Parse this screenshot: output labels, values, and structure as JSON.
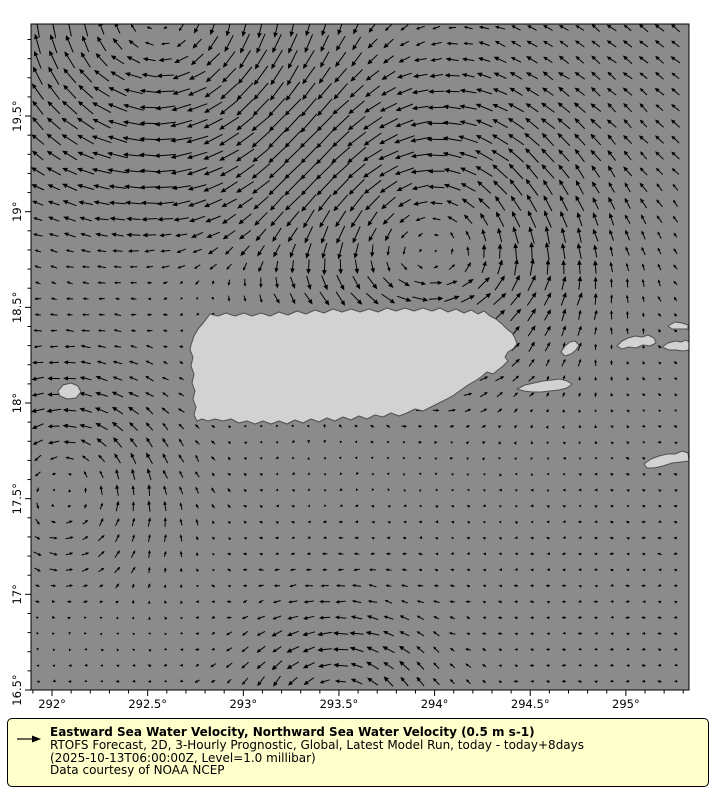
{
  "colors": {
    "page_bg": "#ffffff",
    "sea": "#8b8b8b",
    "land": "#d2d2d2",
    "land_edge": "#4f4f4f",
    "frame": "#000000",
    "arrow": "#000000",
    "tick_label": "#000000",
    "legend_bg": "#ffffcc",
    "legend_border": "#000000"
  },
  "plot": {
    "x": 31,
    "y": 24,
    "w": 658,
    "h": 666
  },
  "axes": {
    "x": {
      "min": 291.89,
      "max": 295.33,
      "minor_step": 0.1,
      "ticks": [
        {
          "v": 292.0,
          "label": "292°"
        },
        {
          "v": 292.5,
          "label": "292.5°"
        },
        {
          "v": 293.0,
          "label": "293°"
        },
        {
          "v": 293.5,
          "label": "293.5°"
        },
        {
          "v": 294.0,
          "label": "294°"
        },
        {
          "v": 294.5,
          "label": "294.5°"
        },
        {
          "v": 295.0,
          "label": "295°"
        }
      ]
    },
    "y": {
      "min": 16.5,
      "max": 19.981,
      "minor_step": 0.1,
      "ticks": [
        {
          "v": 16.5,
          "label": "16.5°"
        },
        {
          "v": 17.0,
          "label": "17°"
        },
        {
          "v": 17.5,
          "label": "17.5°"
        },
        {
          "v": 18.0,
          "label": "18°"
        },
        {
          "v": 18.5,
          "label": "18.5°"
        },
        {
          "v": 19.0,
          "label": "19°"
        },
        {
          "v": 19.5,
          "label": "19.5°"
        }
      ]
    }
  },
  "quiver": {
    "grid_step_deg": 0.08333,
    "lon_start": 291.925,
    "lat_start": 16.545,
    "px_per_mps": 36,
    "max_len_px": 26,
    "noise": 0.07,
    "vortices": [
      {
        "cx": 292.55,
        "cy": 20.05,
        "s": 0.85,
        "A": 0.55
      },
      {
        "cx": 294.0,
        "cy": 18.85,
        "s": 0.72,
        "A": -0.36
      },
      {
        "cx": 292.05,
        "cy": 17.6,
        "s": 0.55,
        "A": -0.2
      },
      {
        "cx": 293.5,
        "cy": 16.4,
        "s": 0.45,
        "A": -0.16
      }
    ],
    "jets": [
      {
        "amp": 0.15,
        "lat0": 18.57,
        "sig": 0.13,
        "lonA": 292.6,
        "lonB": 294.75
      },
      {
        "amp": -0.1,
        "lat0": 19.02,
        "sig": 0.33,
        "lonA": 291.8,
        "lonB": 293.9
      }
    ],
    "bg_nw": {
      "u": -0.3,
      "v": 0.24,
      "lon0": 294.3,
      "lat0": 19.05,
      "k": 0.45
    },
    "bg_south": {
      "u": -0.1,
      "lat0": 18.25,
      "k": 0.35
    }
  },
  "land": [
    {
      "name": "puerto-rico",
      "points": [
        [
          191,
          345
        ],
        [
          194,
          336
        ],
        [
          198,
          329
        ],
        [
          204,
          322
        ],
        [
          210,
          314
        ],
        [
          218,
          316
        ],
        [
          226,
          313
        ],
        [
          235,
          316
        ],
        [
          244,
          313
        ],
        [
          252,
          316
        ],
        [
          261,
          313
        ],
        [
          270,
          316
        ],
        [
          279,
          312
        ],
        [
          288,
          315
        ],
        [
          297,
          311
        ],
        [
          306,
          314
        ],
        [
          315,
          310
        ],
        [
          324,
          313
        ],
        [
          333,
          309
        ],
        [
          342,
          312
        ],
        [
          351,
          309
        ],
        [
          360,
          312
        ],
        [
          369,
          309
        ],
        [
          378,
          312
        ],
        [
          387,
          308
        ],
        [
          396,
          311
        ],
        [
          405,
          308
        ],
        [
          414,
          311
        ],
        [
          423,
          308
        ],
        [
          432,
          311
        ],
        [
          440,
          308
        ],
        [
          448,
          312
        ],
        [
          456,
          309
        ],
        [
          464,
          313
        ],
        [
          471,
          310
        ],
        [
          478,
          314
        ],
        [
          484,
          311
        ],
        [
          490,
          316
        ],
        [
          496,
          319
        ],
        [
          502,
          324
        ],
        [
          507,
          329
        ],
        [
          512,
          333
        ],
        [
          515,
          338
        ],
        [
          517,
          344
        ],
        [
          513,
          349
        ],
        [
          508,
          352
        ],
        [
          505,
          357
        ],
        [
          508,
          361
        ],
        [
          503,
          366
        ],
        [
          498,
          370
        ],
        [
          493,
          374
        ],
        [
          487,
          372
        ],
        [
          481,
          377
        ],
        [
          475,
          381
        ],
        [
          468,
          385
        ],
        [
          461,
          390
        ],
        [
          454,
          395
        ],
        [
          447,
          399
        ],
        [
          439,
          403
        ],
        [
          431,
          407
        ],
        [
          423,
          411
        ],
        [
          415,
          409
        ],
        [
          407,
          413
        ],
        [
          399,
          416
        ],
        [
          391,
          413
        ],
        [
          383,
          417
        ],
        [
          375,
          415
        ],
        [
          367,
          419
        ],
        [
          359,
          416
        ],
        [
          351,
          420
        ],
        [
          343,
          417
        ],
        [
          335,
          421
        ],
        [
          327,
          418
        ],
        [
          319,
          422
        ],
        [
          311,
          419
        ],
        [
          303,
          423
        ],
        [
          295,
          420
        ],
        [
          287,
          424
        ],
        [
          279,
          421
        ],
        [
          271,
          424
        ],
        [
          263,
          421
        ],
        [
          255,
          424
        ],
        [
          247,
          421
        ],
        [
          239,
          423
        ],
        [
          231,
          419
        ],
        [
          223,
          421
        ],
        [
          215,
          419
        ],
        [
          208,
          421
        ],
        [
          202,
          419
        ],
        [
          197,
          421
        ],
        [
          194,
          415
        ],
        [
          196,
          407
        ],
        [
          193,
          399
        ],
        [
          195,
          391
        ],
        [
          192,
          383
        ],
        [
          194,
          374
        ],
        [
          191,
          366
        ],
        [
          193,
          357
        ],
        [
          190,
          350
        ]
      ]
    },
    {
      "name": "vieques",
      "points": [
        [
          517,
          389
        ],
        [
          525,
          385
        ],
        [
          534,
          383
        ],
        [
          543,
          381
        ],
        [
          552,
          380
        ],
        [
          560,
          379
        ],
        [
          567,
          381
        ],
        [
          572,
          384
        ],
        [
          567,
          388
        ],
        [
          559,
          390
        ],
        [
          550,
          391
        ],
        [
          541,
          392
        ],
        [
          532,
          392
        ],
        [
          524,
          391
        ]
      ]
    },
    {
      "name": "culebra",
      "points": [
        [
          561,
          352
        ],
        [
          565,
          346
        ],
        [
          570,
          342
        ],
        [
          575,
          341
        ],
        [
          579,
          345
        ],
        [
          576,
          350
        ],
        [
          571,
          354
        ],
        [
          565,
          356
        ]
      ]
    },
    {
      "name": "st-thomas",
      "points": [
        [
          617,
          346
        ],
        [
          622,
          341
        ],
        [
          628,
          338
        ],
        [
          635,
          336
        ],
        [
          642,
          337
        ],
        [
          648,
          335
        ],
        [
          654,
          338
        ],
        [
          656,
          343
        ],
        [
          650,
          346
        ],
        [
          643,
          345
        ],
        [
          636,
          348
        ],
        [
          629,
          347
        ],
        [
          622,
          349
        ]
      ]
    },
    {
      "name": "st-john-tortola",
      "points": [
        [
          662,
          347
        ],
        [
          668,
          343
        ],
        [
          675,
          341
        ],
        [
          681,
          342
        ],
        [
          686,
          340
        ],
        [
          689,
          342
        ],
        [
          689,
          350
        ],
        [
          683,
          351
        ],
        [
          676,
          350
        ],
        [
          669,
          350
        ]
      ]
    },
    {
      "name": "jost-van-dyke",
      "points": [
        [
          668,
          326
        ],
        [
          675,
          322
        ],
        [
          682,
          323
        ],
        [
          688,
          325
        ],
        [
          688,
          329
        ],
        [
          679,
          329
        ],
        [
          672,
          329
        ]
      ]
    },
    {
      "name": "st-croix",
      "points": [
        [
          644,
          464
        ],
        [
          651,
          459
        ],
        [
          659,
          456
        ],
        [
          667,
          454
        ],
        [
          675,
          454
        ],
        [
          682,
          451
        ],
        [
          688,
          453
        ],
        [
          689,
          461
        ],
        [
          681,
          462
        ],
        [
          672,
          463
        ],
        [
          663,
          466
        ],
        [
          654,
          468
        ],
        [
          647,
          468
        ]
      ]
    },
    {
      "name": "mona",
      "points": [
        [
          58,
          391
        ],
        [
          63,
          385
        ],
        [
          71,
          383
        ],
        [
          78,
          386
        ],
        [
          81,
          392
        ],
        [
          76,
          398
        ],
        [
          67,
          399
        ],
        [
          60,
          396
        ]
      ]
    }
  ],
  "legend": {
    "title": "Eastward Sea Water Velocity, Northward Sea Water Velocity (0.5 m s-1)",
    "line2": "RTOFS Forecast, 2D, 3-Hourly Prognostic, Global, Latest Model Run, today - today+8days",
    "line3": "(2025-10-13T06:00:00Z, Level=1.0 millibar)",
    "line4": "Data courtesy of NOAA NCEP"
  }
}
